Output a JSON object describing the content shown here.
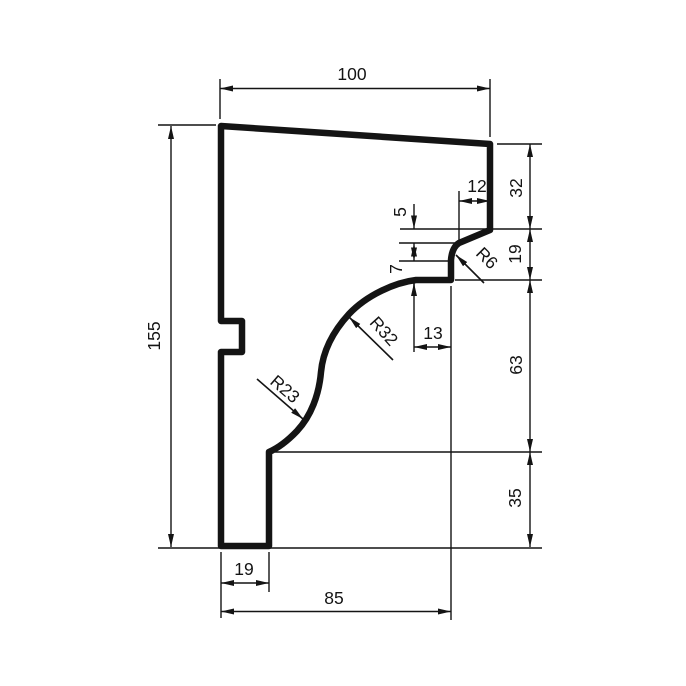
{
  "drawing": {
    "type": "dimensioned profile cross-section (cornice moulding)",
    "background": "#ffffff",
    "line_color": "#141414",
    "labels": {
      "top_width": "100",
      "height": "155",
      "right_32": "32",
      "right_19": "19",
      "right_63": "63",
      "right_35": "35",
      "drip_12": "12",
      "drip_5": "5",
      "step_7": "7",
      "soffit_13": "13",
      "bottom_19": "19",
      "bottom_85": "85",
      "radius_r6": "R6",
      "radius_r32": "R32",
      "radius_r23": "R23"
    }
  }
}
